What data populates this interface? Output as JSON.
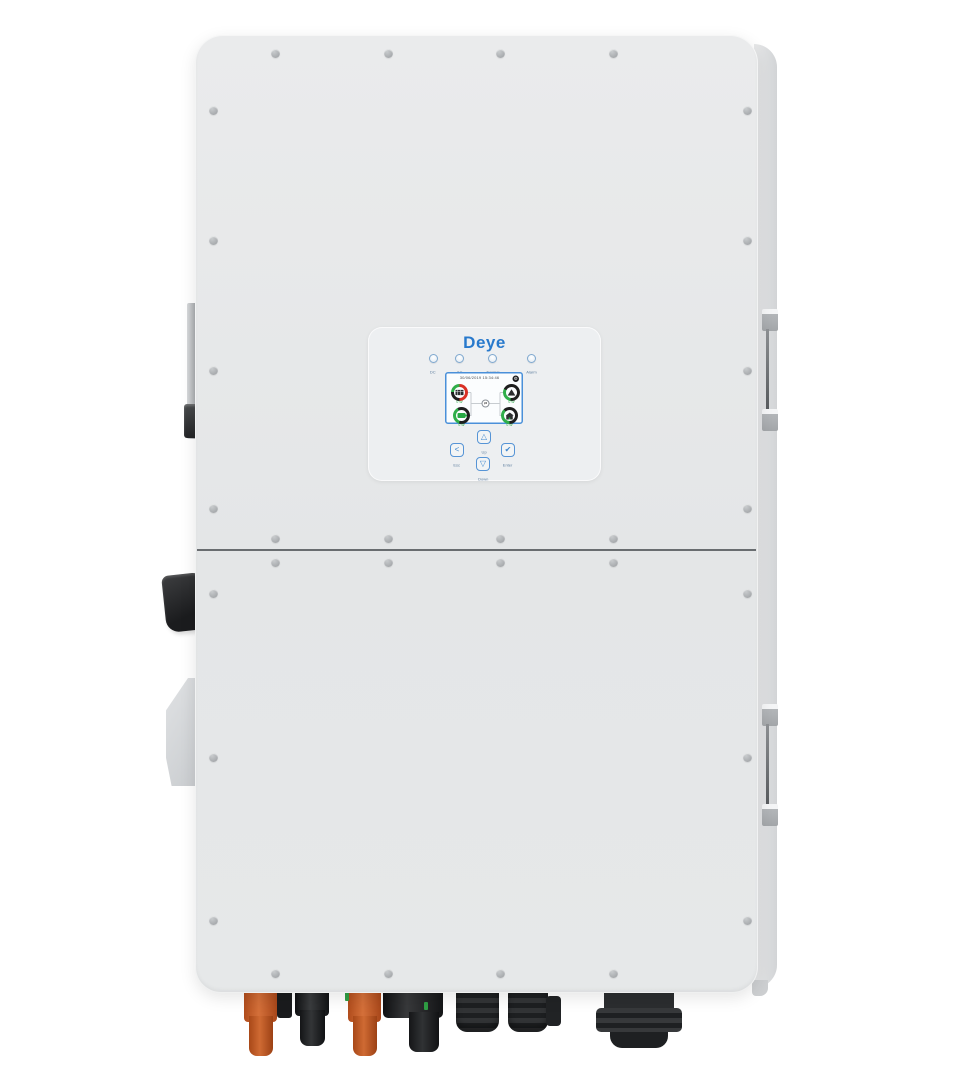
{
  "brand": "Deye",
  "control_panel": {
    "logo": "Deye",
    "leds": [
      {
        "name": "led-dc",
        "label": "DC"
      },
      {
        "name": "led-ac",
        "label": "AC"
      },
      {
        "name": "led-normal",
        "label": "Normal"
      },
      {
        "name": "led-alarm",
        "label": "Alarm"
      }
    ],
    "screen": {
      "timestamp": "30/06/2019 15:34:46",
      "settings_icon": "⚙",
      "center_icon": "⇄",
      "nodes": {
        "pv": {
          "icon": "solar-panel-icon",
          "value": "0 W"
        },
        "grid": {
          "icon": "grid-tower-icon",
          "value": "0 W"
        },
        "battery": {
          "icon": "battery-icon",
          "value": "0 W"
        },
        "load": {
          "icon": "home-load-icon",
          "value": "0 W"
        }
      }
    },
    "buttons": [
      {
        "name": "esc",
        "glyph": "<",
        "label": "Esc"
      },
      {
        "name": "up",
        "glyph": "△",
        "label": "Up"
      },
      {
        "name": "down",
        "glyph": "▽",
        "label": "Down"
      },
      {
        "name": "enter",
        "glyph": "✔",
        "label": "Enter"
      }
    ]
  },
  "colors": {
    "accent_blue": "#2879cc",
    "screen_border": "#4a90d9",
    "arc_green": "#2fae49",
    "arc_red": "#d93025",
    "arc_dark": "#1e1e1e",
    "connector_orange": "#c45b24",
    "connector_black": "#1d1f21",
    "body_gray": "#e7e9ea"
  },
  "hardware": {
    "dc_switch": "dc-switch-knob",
    "ports": [
      "pv-connector-orange-1",
      "pv-connector-black-1",
      "pv-connector-orange-2",
      "pv-connector-black-2",
      "cable-gland-small-1",
      "cable-gland-small-2",
      "cable-gland-large"
    ]
  }
}
